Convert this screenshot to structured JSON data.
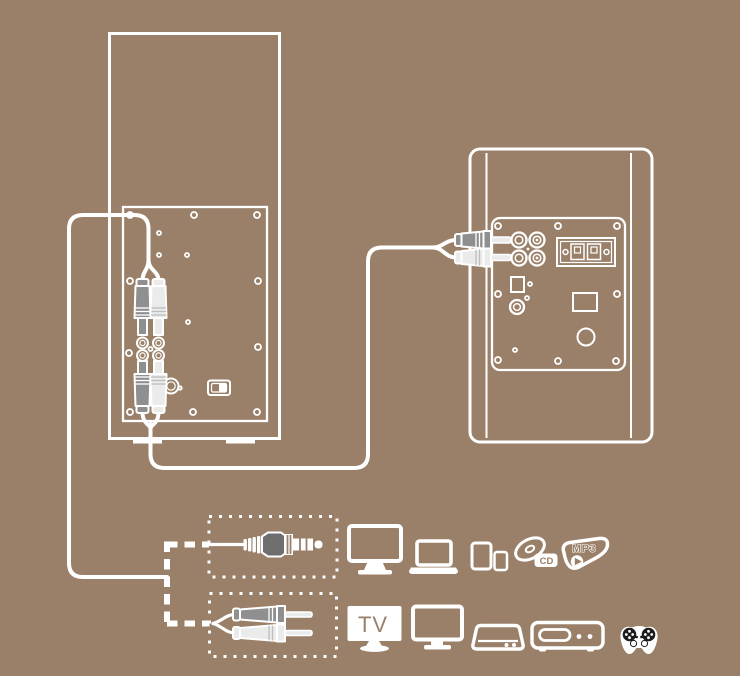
{
  "theme": {
    "background": "#9a8069",
    "line": "#ffffff",
    "plug_dark": "#8f8f8f",
    "plug_light": "#ebebeb",
    "aux_body": "#6e6e6e",
    "stripe_gray": "#bdbdbd",
    "controller_detail": "#1c1c1c"
  },
  "labels": {
    "tv": "TV",
    "cd": "CD",
    "mp3": "MP3"
  },
  "diagram": {
    "speakers": [
      {
        "id": "left-speaker",
        "view": "rear-panel",
        "plugs": [
          "rca-input-plugs-top",
          "rca-link-plugs-bottom"
        ]
      },
      {
        "id": "right-speaker",
        "view": "rear-panel",
        "plugs": [
          "rca-link-plugs-left"
        ]
      }
    ],
    "adapter_options": [
      {
        "id": "aux-3-5mm-plug",
        "icon": "aux-plug-icon"
      },
      {
        "id": "rca-stereo-plugs",
        "icon": "rca-plugs-icon"
      }
    ],
    "devices": {
      "aux_row": [
        "desktop-monitor-icon",
        "laptop-icon",
        "tablet-and-phone-icon",
        "cd-player-icon",
        "mp3-player-icon"
      ],
      "rca_row": [
        "tv-icon",
        "desktop-monitor-icon",
        "set-top-box-icon",
        "dvd-player-icon",
        "game-controller-icon"
      ]
    }
  }
}
